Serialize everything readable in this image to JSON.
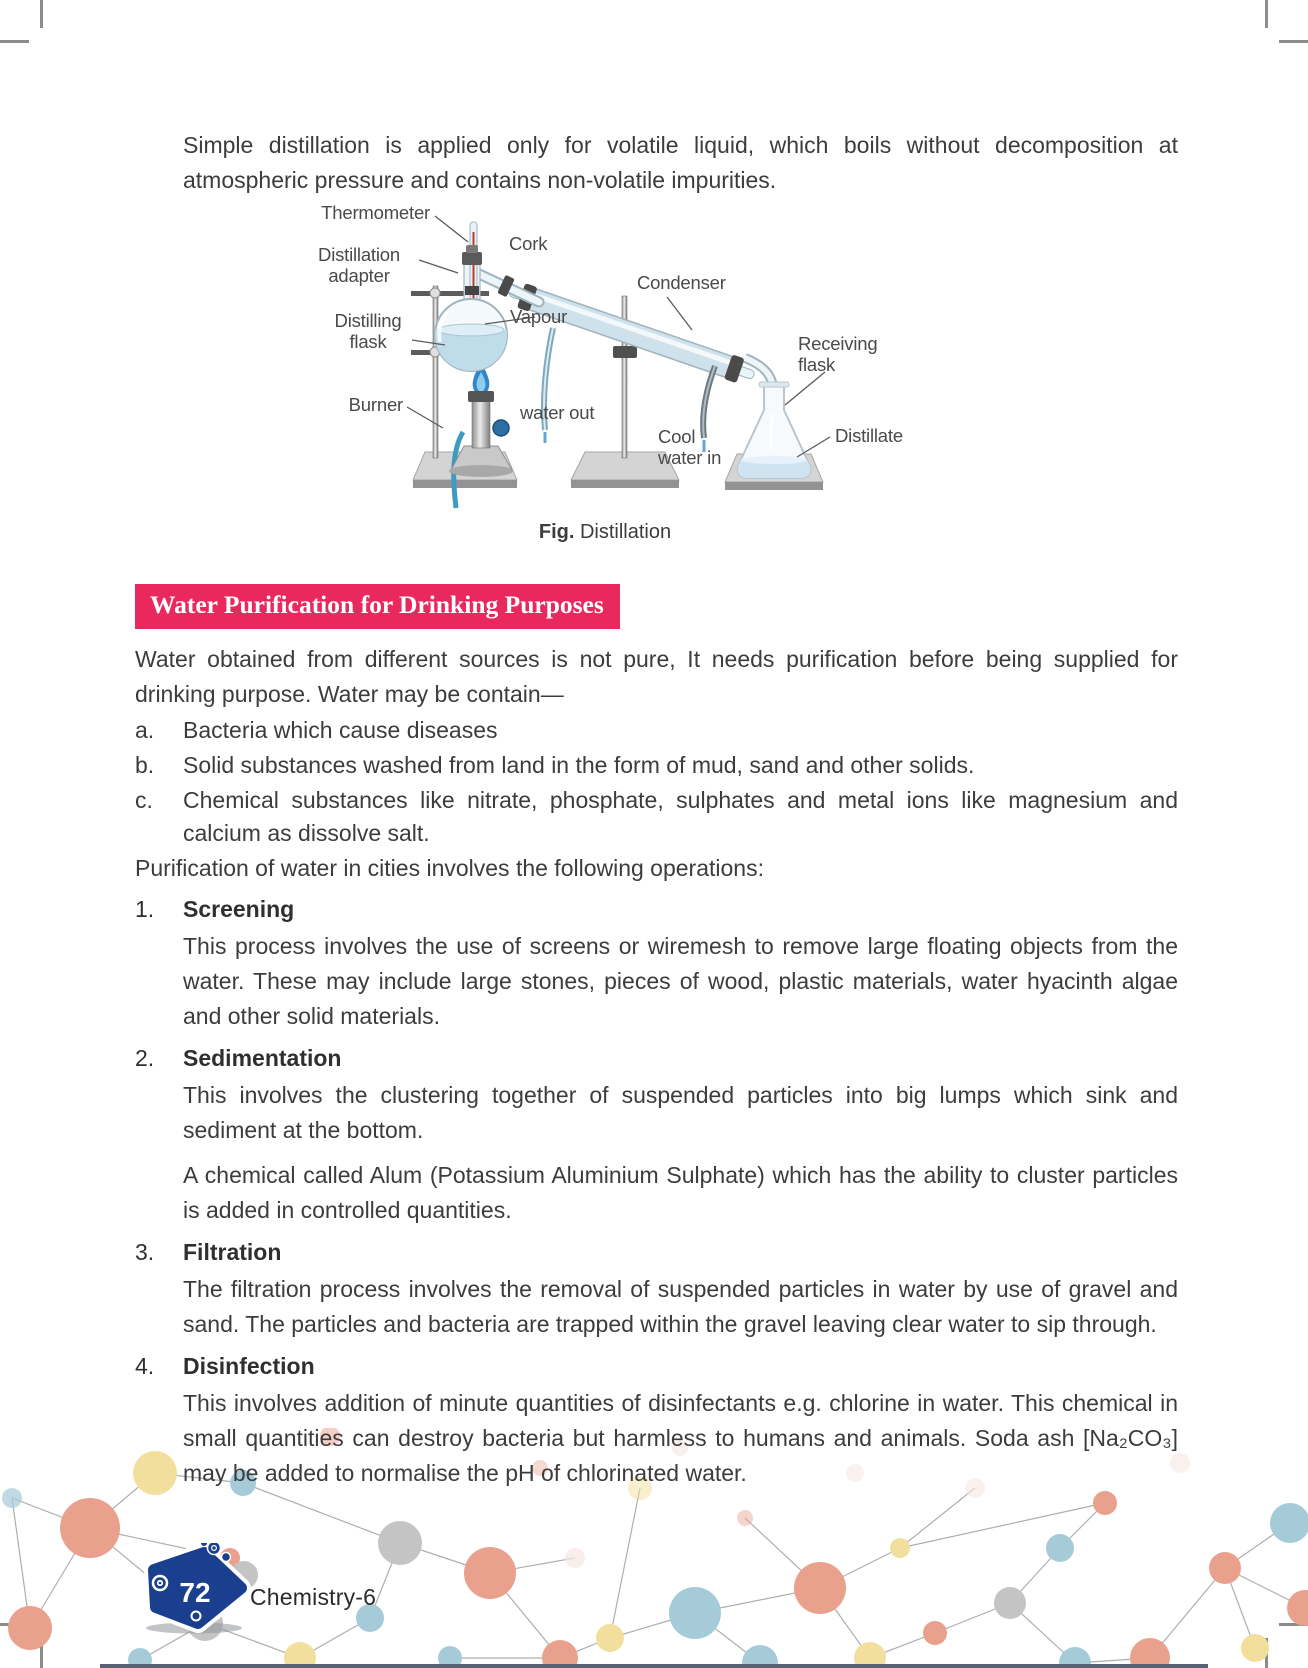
{
  "intro_paragraph": "Simple distillation is applied only for volatile liquid, which boils without decomposition at atmospheric pressure and contains non-volatile impurities.",
  "figure": {
    "caption_prefix": "Fig.",
    "caption_text": "Distillation",
    "labels": {
      "thermometer": "Thermometer",
      "cork": "Cork",
      "distillation_adapter": "Distillation adapter",
      "distilling_flask": "Distilling flask",
      "vapour": "Vapour",
      "condenser": "Condenser",
      "receiving_flask": "Receiving flask",
      "burner": "Burner",
      "water_out": "water out",
      "cool_water_in": "Cool water in",
      "distillate": "Distillate"
    }
  },
  "section": {
    "heading": "Water Purification for Drinking Purposes",
    "intro": "Water obtained from different sources is not pure, It needs purification before being supplied for drinking purpose. Water may be contain—",
    "lettered_items": [
      {
        "letter": "a.",
        "text": "Bacteria which cause diseases"
      },
      {
        "letter": "b.",
        "text": "Solid substances washed from land in the form of mud, sand and other solids."
      },
      {
        "letter": "c.",
        "text": "Chemical substances like nitrate, phosphate, sulphates and metal ions like magnesium and calcium as dissolve salt."
      }
    ],
    "operations_intro": "Purification of water in cities involves the following operations:",
    "operations": [
      {
        "number": "1.",
        "title": "Screening",
        "paragraphs": [
          "This process involves the use of screens or wiremesh to remove large floating objects from the water. These may include large stones, pieces of wood, plastic materials, water hyacinth algae and other solid materials."
        ]
      },
      {
        "number": "2.",
        "title": "Sedimentation",
        "paragraphs": [
          "This involves the clustering together of suspended particles into big lumps which sink and sediment at the bottom.",
          "A chemical called Alum (Potassium Aluminium Sulphate) which has the ability to cluster particles is added in controlled quantities."
        ]
      },
      {
        "number": "3.",
        "title": "Filtration",
        "paragraphs": [
          "The filtration process involves the removal of suspended particles in water by use of gravel and sand. The particles and bacteria are trapped within the gravel leaving clear water to sip through."
        ]
      },
      {
        "number": "4.",
        "title": "Disinfection",
        "paragraphs": [
          "This involves addition of minute quantities of disinfectants e.g. chlorine in water. This chemical in small quantities can destroy bacteria but harmless to humans and animals. Soda ash [Na₂CO₃] may be added to normalise the pH of chlorinated water."
        ]
      }
    ]
  },
  "footer": {
    "page_number": "72",
    "book_title": "Chemistry-6"
  },
  "colors": {
    "heading_banner": "#e9295e",
    "badge_blue": "#1b3f8f",
    "body_text": "#3c3c3c"
  }
}
